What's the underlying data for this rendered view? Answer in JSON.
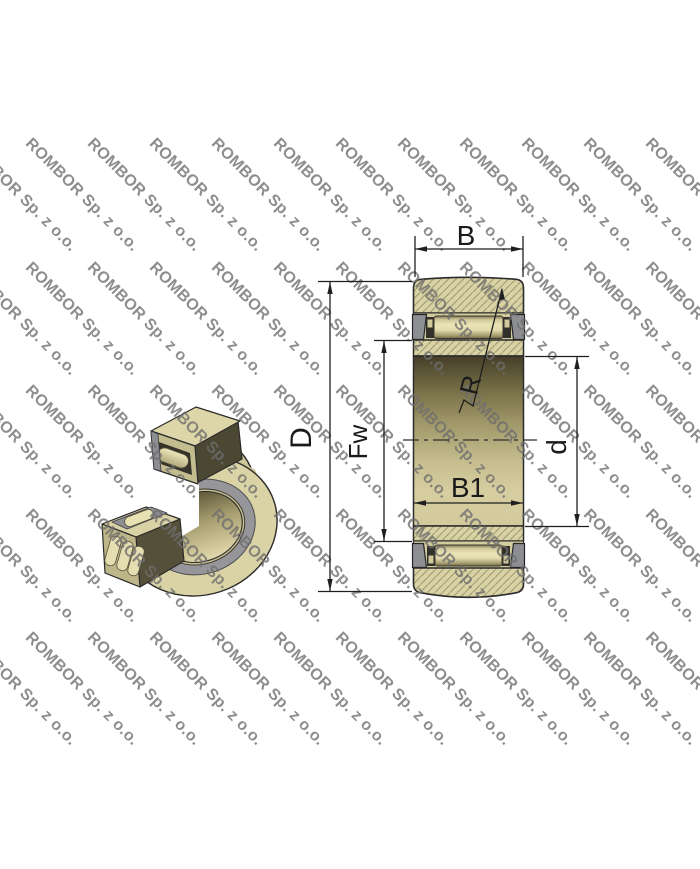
{
  "watermark": {
    "text": "ROMBOR Sp. z o.o.",
    "color": "#6e6e6e"
  },
  "dimensions": {
    "outer_width": "B",
    "outer_diameter": "D",
    "raceway_diameter": "Fw",
    "inner_ring_width": "B1",
    "corner_radius": "R",
    "bore_diameter": "d"
  },
  "colors": {
    "body_tan": "#d9d2a4",
    "hatch_line": "#a09a73",
    "outline": "#2b2b2b",
    "cage_gray": "#8d8e92",
    "bore_dark": "#453f29",
    "bore_light": "#d6cea0",
    "dimension_line": "#1f1f1f",
    "watermark_gray": "#6e6e6e"
  }
}
